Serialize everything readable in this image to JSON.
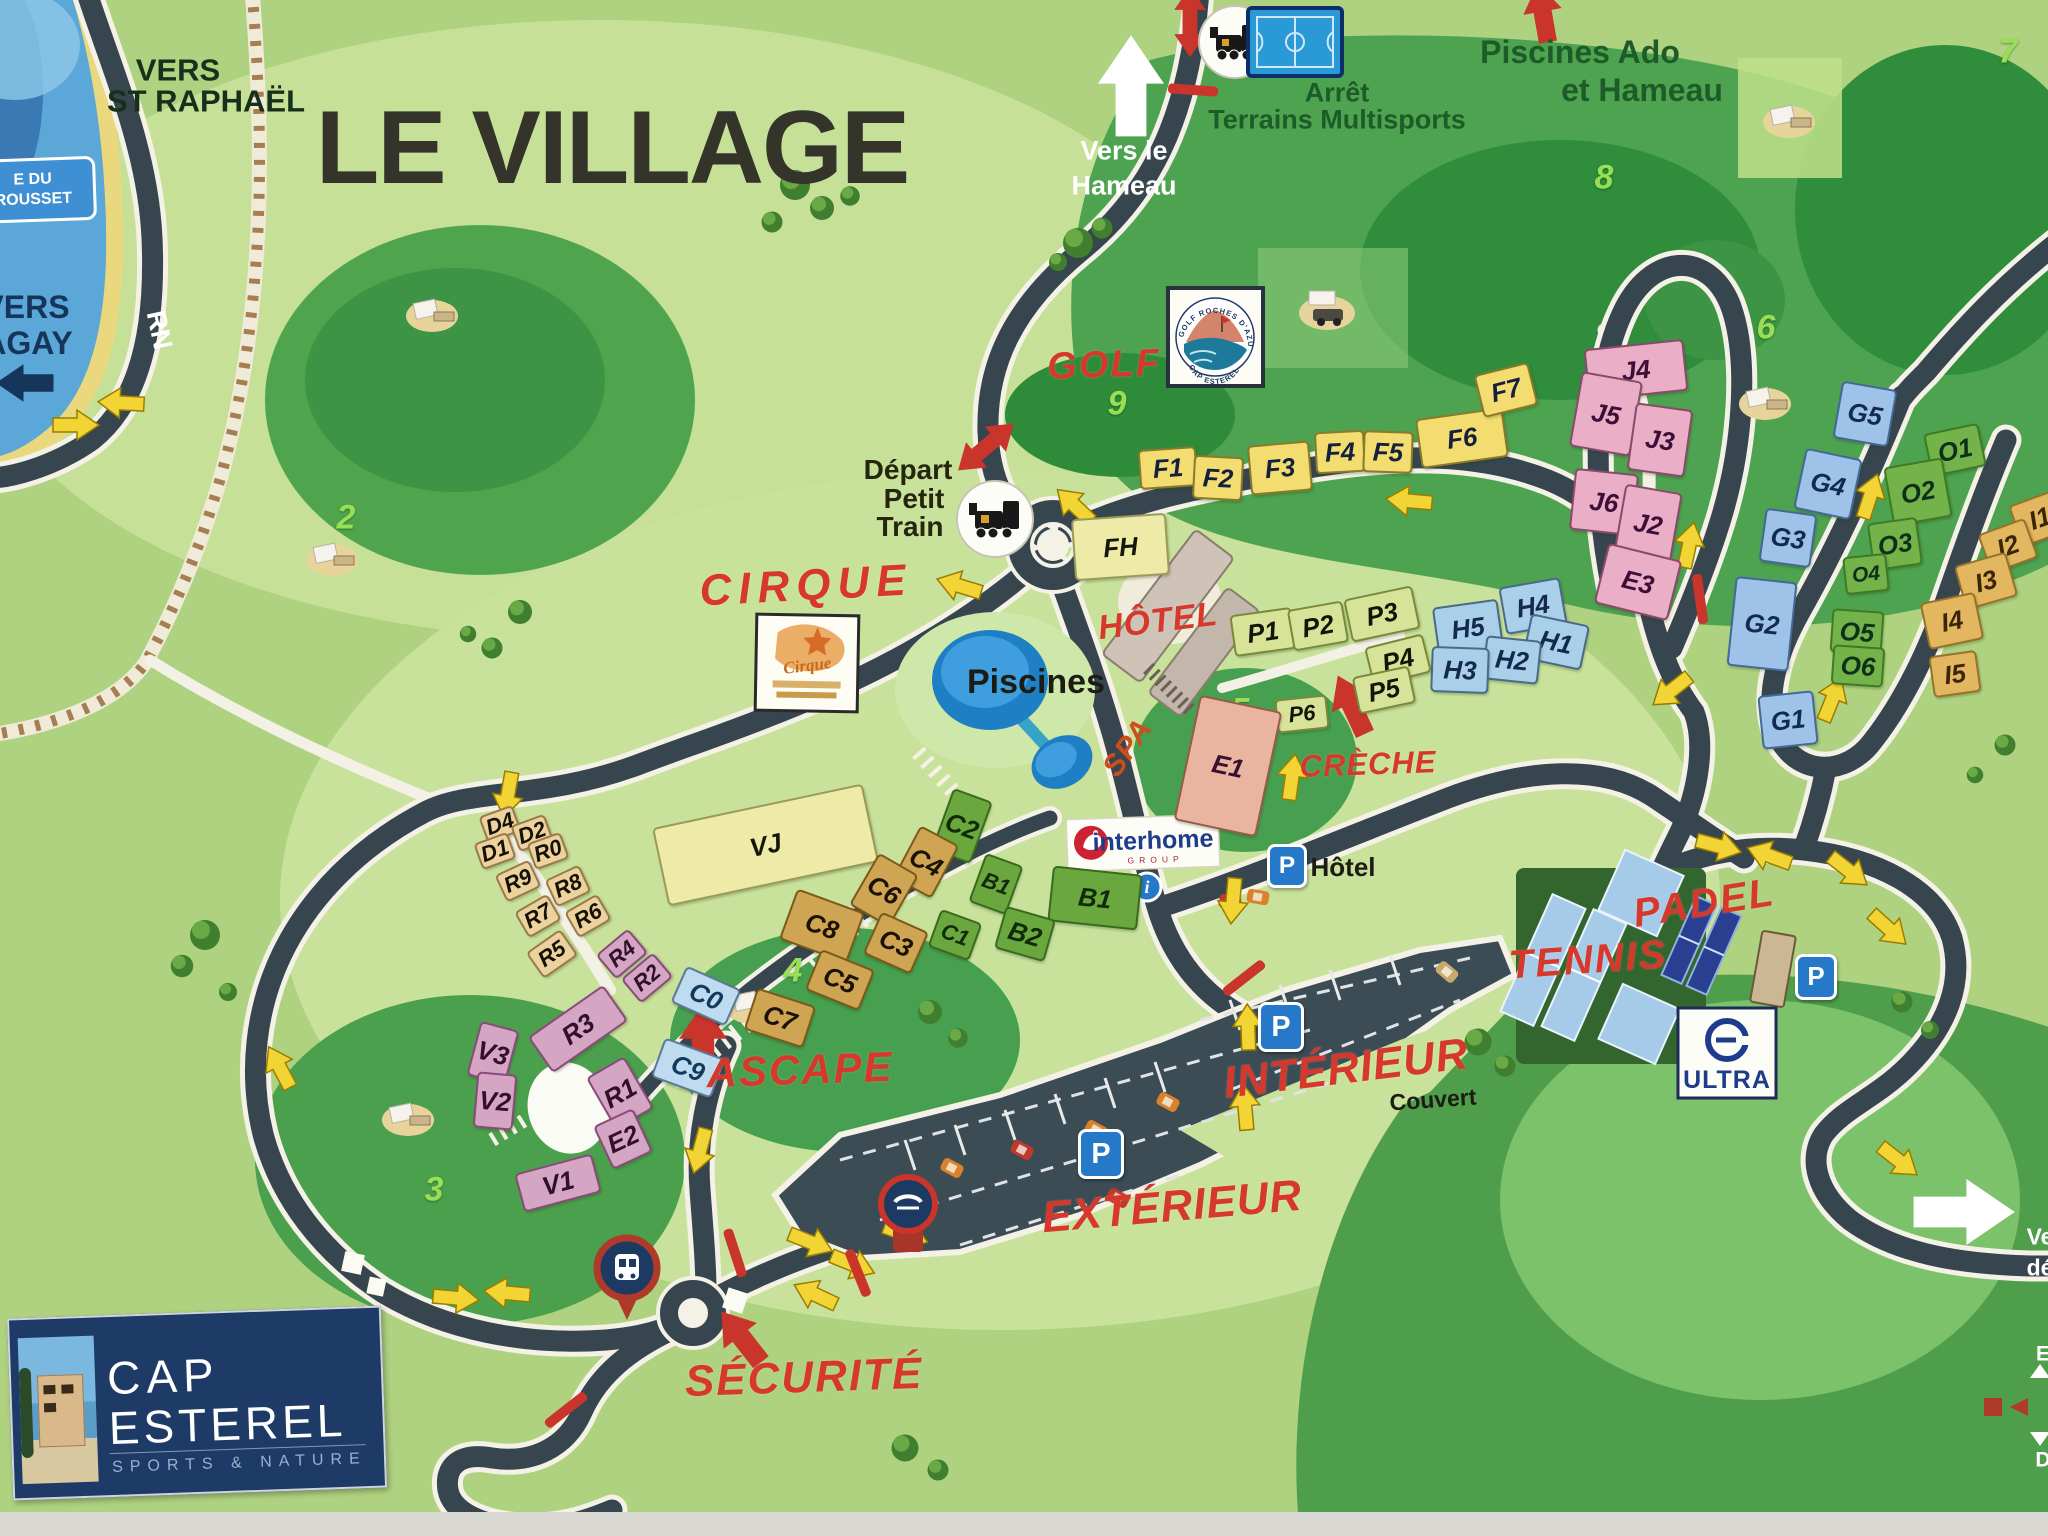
{
  "title": "LE VILLAGE",
  "colors": {
    "map_green": "#afd280",
    "dark_green": "#3c9444",
    "road": "#37464e",
    "accent_red": "#d6392b",
    "arrow_yellow": "#f2d435",
    "water_blue": "#5aa7d8",
    "navy_logo": "#1e3a66",
    "parking_blue": "#2678c8"
  },
  "signs": {
    "vers_st_raphael_1": "VERS",
    "vers_st_raphael_2": "ST RAPHAËL",
    "vers_agay_1": "VERS",
    "vers_agay_2": "AGAY",
    "beach_sign_1": "E DU",
    "beach_sign_2": "ROUSSET",
    "rn": "RN",
    "vers_hameau_1": "Vers le",
    "vers_hameau_2": "Hameau",
    "arret_1": "Arrêt",
    "arret_2": "Terrains Multisports",
    "piscines_ado_1": "Piscines Ado",
    "piscines_ado_2": "et Hameau",
    "depart_1": "Départ",
    "depart_2": "Petit",
    "depart_3": "Train",
    "edge_ve": "Ve",
    "edge_de": "dé",
    "edge_e": "E",
    "edge_d": "D"
  },
  "poi": [
    {
      "id": "golf",
      "text": "GOLF",
      "x": 1104,
      "y": 365,
      "s": 38,
      "rot": -2,
      "c": "red",
      "ls": 2
    },
    {
      "id": "cirque",
      "text": "CIRQUE",
      "x": 806,
      "y": 586,
      "s": 44,
      "rot": -3,
      "c": "red",
      "ls": 7
    },
    {
      "id": "hotel",
      "text": "HÔTEL",
      "x": 1158,
      "y": 621,
      "s": 34,
      "rot": -7,
      "c": "red",
      "ls": 1
    },
    {
      "id": "spa",
      "text": "SPA",
      "x": 1128,
      "y": 748,
      "s": 30,
      "rot": -55,
      "c": "orange",
      "ls": 1
    },
    {
      "id": "creche",
      "text": "CRÈCHE",
      "x": 1368,
      "y": 764,
      "s": 31,
      "rot": -2,
      "c": "red",
      "ls": 1
    },
    {
      "id": "ascape",
      "text": "ASCAPE",
      "x": 800,
      "y": 1070,
      "s": 42,
      "rot": -2,
      "c": "red",
      "ls": 2
    },
    {
      "id": "padel",
      "text": "PADEL",
      "x": 1704,
      "y": 903,
      "s": 40,
      "rot": -9,
      "c": "red",
      "ls": 2
    },
    {
      "id": "tennis",
      "text": "TENNIS",
      "x": 1588,
      "y": 960,
      "s": 40,
      "rot": -4,
      "c": "red",
      "ls": 2
    },
    {
      "id": "interieur",
      "text": "INTÉRIEUR",
      "x": 1346,
      "y": 1069,
      "s": 44,
      "rot": -7,
      "c": "red",
      "ls": 1
    },
    {
      "id": "couvert",
      "text": "Couvert",
      "x": 1433,
      "y": 1100,
      "s": 23,
      "rot": -4,
      "c": "black",
      "ls": 0
    },
    {
      "id": "exterieur",
      "text": "EXTÉRIEUR",
      "x": 1172,
      "y": 1207,
      "s": 44,
      "rot": -5,
      "c": "red",
      "ls": 1
    },
    {
      "id": "securite",
      "text": "SÉCURITÉ",
      "x": 804,
      "y": 1378,
      "s": 44,
      "rot": -2,
      "c": "red",
      "ls": 2
    },
    {
      "id": "piscines",
      "text": "Piscines",
      "x": 1036,
      "y": 682,
      "s": 34,
      "rot": 0,
      "c": "black",
      "ls": 0
    },
    {
      "id": "parking-hotel",
      "text": "Hôtel",
      "x": 1343,
      "y": 867,
      "s": 26,
      "rot": 0,
      "c": "black",
      "ls": 0
    }
  ],
  "golf_holes": [
    {
      "n": "2",
      "x": 346,
      "y": 518
    },
    {
      "n": "3",
      "x": 434,
      "y": 1190
    },
    {
      "n": "4",
      "x": 793,
      "y": 971
    },
    {
      "n": "5",
      "x": 1240,
      "y": 711
    },
    {
      "n": "6",
      "x": 1766,
      "y": 328
    },
    {
      "n": "7",
      "x": 2008,
      "y": 52
    },
    {
      "n": "8",
      "x": 1604,
      "y": 178
    },
    {
      "n": "9",
      "x": 1117,
      "y": 404
    }
  ],
  "buildings": [
    {
      "label": "F1",
      "x": 1168,
      "y": 468,
      "w": 58,
      "h": 40,
      "r": -4,
      "c": "yellow"
    },
    {
      "label": "F2",
      "x": 1218,
      "y": 478,
      "w": 50,
      "h": 44,
      "r": 3,
      "c": "yellow"
    },
    {
      "label": "F3",
      "x": 1280,
      "y": 468,
      "w": 62,
      "h": 50,
      "r": -5,
      "c": "yellow"
    },
    {
      "label": "F4",
      "x": 1340,
      "y": 452,
      "w": 50,
      "h": 42,
      "r": -3,
      "c": "yellow"
    },
    {
      "label": "F5",
      "x": 1388,
      "y": 452,
      "w": 50,
      "h": 42,
      "r": 2,
      "c": "yellow"
    },
    {
      "label": "F6",
      "x": 1462,
      "y": 438,
      "w": 88,
      "h": 50,
      "r": -8,
      "c": "yellow"
    },
    {
      "label": "F7",
      "x": 1506,
      "y": 390,
      "w": 56,
      "h": 44,
      "r": -14,
      "c": "yellow"
    },
    {
      "label": "FH",
      "x": 1120,
      "y": 547,
      "w": 95,
      "h": 62,
      "r": -4,
      "c": "paleyellow"
    },
    {
      "label": "VJ",
      "x": 765,
      "y": 845,
      "w": 215,
      "h": 80,
      "r": -12,
      "c": "paleyellow"
    },
    {
      "label": "J4",
      "x": 1636,
      "y": 370,
      "w": 100,
      "h": 52,
      "r": -6,
      "c": "pink"
    },
    {
      "label": "J5",
      "x": 1606,
      "y": 414,
      "w": 62,
      "h": 76,
      "r": 10,
      "c": "pink"
    },
    {
      "label": "J3",
      "x": 1660,
      "y": 440,
      "w": 58,
      "h": 68,
      "r": 8,
      "c": "pink"
    },
    {
      "label": "J6",
      "x": 1604,
      "y": 502,
      "w": 64,
      "h": 62,
      "r": 6,
      "c": "pink"
    },
    {
      "label": "J2",
      "x": 1648,
      "y": 524,
      "w": 58,
      "h": 72,
      "r": 10,
      "c": "pink"
    },
    {
      "label": "E3",
      "x": 1638,
      "y": 582,
      "w": 76,
      "h": 62,
      "r": 14,
      "c": "pink"
    },
    {
      "label": "H4",
      "x": 1533,
      "y": 606,
      "w": 62,
      "h": 48,
      "r": -10,
      "c": "blue"
    },
    {
      "label": "H5",
      "x": 1468,
      "y": 628,
      "w": 66,
      "h": 50,
      "r": -8,
      "c": "blue"
    },
    {
      "label": "H1",
      "x": 1556,
      "y": 642,
      "w": 60,
      "h": 46,
      "r": 12,
      "c": "blue"
    },
    {
      "label": "H2",
      "x": 1512,
      "y": 660,
      "w": 56,
      "h": 44,
      "r": 6,
      "c": "blue"
    },
    {
      "label": "H3",
      "x": 1460,
      "y": 670,
      "w": 58,
      "h": 46,
      "r": 2,
      "c": "blue"
    },
    {
      "label": "P1",
      "x": 1263,
      "y": 632,
      "w": 62,
      "h": 42,
      "r": -8,
      "c": "pgreen"
    },
    {
      "label": "P2",
      "x": 1318,
      "y": 626,
      "w": 56,
      "h": 42,
      "r": -10,
      "c": "pgreen"
    },
    {
      "label": "P3",
      "x": 1382,
      "y": 614,
      "w": 70,
      "h": 44,
      "r": -12,
      "c": "pgreen"
    },
    {
      "label": "P4",
      "x": 1398,
      "y": 660,
      "w": 60,
      "h": 40,
      "r": -14,
      "c": "pgreen"
    },
    {
      "label": "P5",
      "x": 1384,
      "y": 690,
      "w": 58,
      "h": 38,
      "r": -12,
      "c": "pgreen"
    },
    {
      "label": "P6",
      "x": 1302,
      "y": 714,
      "w": 52,
      "h": 34,
      "r": -6,
      "c": "pgreen",
      "fs": 22
    },
    {
      "label": "E1",
      "x": 1228,
      "y": 766,
      "w": 84,
      "h": 128,
      "r": 12,
      "c": "salmon"
    },
    {
      "label": "C2",
      "x": 962,
      "y": 826,
      "w": 42,
      "h": 66,
      "r": 20,
      "c": "green"
    },
    {
      "label": "C4",
      "x": 926,
      "y": 862,
      "w": 44,
      "h": 60,
      "r": 28,
      "c": "gold"
    },
    {
      "label": "C6",
      "x": 884,
      "y": 890,
      "w": 46,
      "h": 60,
      "r": 30,
      "c": "gold"
    },
    {
      "label": "C8",
      "x": 822,
      "y": 926,
      "w": 72,
      "h": 54,
      "r": 20,
      "c": "gold"
    },
    {
      "label": "C3",
      "x": 896,
      "y": 943,
      "w": 52,
      "h": 46,
      "r": 24,
      "c": "gold"
    },
    {
      "label": "C5",
      "x": 840,
      "y": 980,
      "w": 58,
      "h": 44,
      "r": 22,
      "c": "gold"
    },
    {
      "label": "C7",
      "x": 780,
      "y": 1018,
      "w": 62,
      "h": 44,
      "r": 18,
      "c": "gold"
    },
    {
      "label": "C0",
      "x": 706,
      "y": 996,
      "w": 60,
      "h": 40,
      "r": 24,
      "c": "bluelight"
    },
    {
      "label": "C9",
      "x": 688,
      "y": 1068,
      "w": 64,
      "h": 42,
      "r": 20,
      "c": "bluelight"
    },
    {
      "label": "B1",
      "x": 996,
      "y": 884,
      "w": 40,
      "h": 52,
      "r": 20,
      "c": "green",
      "fs": 22
    },
    {
      "label": "B1",
      "x": 1095,
      "y": 898,
      "w": 90,
      "h": 56,
      "r": 6,
      "c": "green"
    },
    {
      "label": "B2",
      "x": 1025,
      "y": 934,
      "w": 52,
      "h": 44,
      "r": 16,
      "c": "green"
    },
    {
      "label": "C1",
      "x": 955,
      "y": 935,
      "w": 44,
      "h": 40,
      "r": 20,
      "c": "green",
      "fs": 22
    },
    {
      "label": "D4",
      "x": 500,
      "y": 824,
      "w": 36,
      "h": 28,
      "r": -20,
      "c": "tan",
      "fs": 22
    },
    {
      "label": "D2",
      "x": 532,
      "y": 833,
      "w": 36,
      "h": 28,
      "r": -20,
      "c": "tan",
      "fs": 22
    },
    {
      "label": "D1",
      "x": 495,
      "y": 851,
      "w": 36,
      "h": 28,
      "r": -20,
      "c": "tan",
      "fs": 22
    },
    {
      "label": "R0",
      "x": 548,
      "y": 851,
      "w": 36,
      "h": 28,
      "r": -20,
      "c": "tan",
      "fs": 22
    },
    {
      "label": "R9",
      "x": 518,
      "y": 881,
      "w": 38,
      "h": 30,
      "r": -25,
      "c": "tan",
      "fs": 22
    },
    {
      "label": "R8",
      "x": 568,
      "y": 886,
      "w": 38,
      "h": 30,
      "r": -25,
      "c": "tan",
      "fs": 22
    },
    {
      "label": "R7",
      "x": 538,
      "y": 916,
      "w": 38,
      "h": 30,
      "r": -30,
      "c": "tan",
      "fs": 22
    },
    {
      "label": "R6",
      "x": 588,
      "y": 916,
      "w": 38,
      "h": 30,
      "r": -30,
      "c": "tan",
      "fs": 22
    },
    {
      "label": "R5",
      "x": 552,
      "y": 954,
      "w": 42,
      "h": 32,
      "r": -35,
      "c": "tan",
      "fs": 22
    },
    {
      "label": "R4",
      "x": 622,
      "y": 954,
      "w": 42,
      "h": 32,
      "r": -40,
      "c": "mauve",
      "fs": 22
    },
    {
      "label": "R2",
      "x": 647,
      "y": 978,
      "w": 42,
      "h": 32,
      "r": -40,
      "c": "mauve",
      "fs": 22
    },
    {
      "label": "R3",
      "x": 578,
      "y": 1029,
      "w": 92,
      "h": 44,
      "r": -35,
      "c": "mauve"
    },
    {
      "label": "V3",
      "x": 493,
      "y": 1053,
      "w": 40,
      "h": 56,
      "r": 15,
      "c": "mauve"
    },
    {
      "label": "V2",
      "x": 495,
      "y": 1101,
      "w": 40,
      "h": 56,
      "r": 5,
      "c": "mauve"
    },
    {
      "label": "V1",
      "x": 558,
      "y": 1183,
      "w": 80,
      "h": 40,
      "r": -15,
      "c": "mauve"
    },
    {
      "label": "R1",
      "x": 620,
      "y": 1093,
      "w": 44,
      "h": 60,
      "r": -30,
      "c": "mauve"
    },
    {
      "label": "E2",
      "x": 623,
      "y": 1139,
      "w": 44,
      "h": 48,
      "r": -25,
      "c": "mauve"
    },
    {
      "label": "G5",
      "x": 1865,
      "y": 414,
      "w": 56,
      "h": 58,
      "r": 10,
      "c": "gblue"
    },
    {
      "label": "G4",
      "x": 1828,
      "y": 484,
      "w": 58,
      "h": 62,
      "r": 12,
      "c": "gblue"
    },
    {
      "label": "G3",
      "x": 1788,
      "y": 538,
      "w": 52,
      "h": 54,
      "r": 8,
      "c": "gblue"
    },
    {
      "label": "G2",
      "x": 1762,
      "y": 624,
      "w": 62,
      "h": 90,
      "r": 6,
      "c": "gblue"
    },
    {
      "label": "G1",
      "x": 1788,
      "y": 720,
      "w": 56,
      "h": 54,
      "r": -6,
      "c": "gblue"
    },
    {
      "label": "O1",
      "x": 1955,
      "y": 450,
      "w": 56,
      "h": 44,
      "r": -12,
      "c": "ogreen"
    },
    {
      "label": "O2",
      "x": 1918,
      "y": 492,
      "w": 60,
      "h": 60,
      "r": -10,
      "c": "ogreen"
    },
    {
      "label": "O3",
      "x": 1895,
      "y": 544,
      "w": 50,
      "h": 48,
      "r": -8,
      "c": "ogreen"
    },
    {
      "label": "O4",
      "x": 1866,
      "y": 574,
      "w": 44,
      "h": 38,
      "r": -6,
      "c": "ogreen",
      "fs": 21
    },
    {
      "label": "O5",
      "x": 1857,
      "y": 632,
      "w": 52,
      "h": 44,
      "r": 4,
      "c": "ogreen"
    },
    {
      "label": "O6",
      "x": 1858,
      "y": 666,
      "w": 52,
      "h": 40,
      "r": 4,
      "c": "ogreen"
    },
    {
      "label": "I1",
      "x": 2040,
      "y": 518,
      "w": 52,
      "h": 44,
      "r": -20,
      "c": "itan"
    },
    {
      "label": "I2",
      "x": 2008,
      "y": 546,
      "w": 50,
      "h": 42,
      "r": -20,
      "c": "itan"
    },
    {
      "label": "I3",
      "x": 1986,
      "y": 581,
      "w": 54,
      "h": 46,
      "r": -16,
      "c": "itan"
    },
    {
      "label": "I4",
      "x": 1952,
      "y": 621,
      "w": 56,
      "h": 48,
      "r": -12,
      "c": "itan"
    },
    {
      "label": "I5",
      "x": 1955,
      "y": 674,
      "w": 48,
      "h": 42,
      "r": -8,
      "c": "itan"
    }
  ],
  "psigns": [
    {
      "x": 1287,
      "y": 866,
      "s": 34
    },
    {
      "x": 1281,
      "y": 1027,
      "s": 40
    },
    {
      "x": 1101,
      "y": 1154,
      "s": 40
    },
    {
      "x": 1816,
      "y": 977,
      "s": 36
    }
  ],
  "logos": {
    "parking": "P",
    "info": "i",
    "cap_line1": "CAP",
    "cap_line2": "ESTEREL",
    "cap_tagline": "SPORTS & NATURE",
    "ultra": "ULTRA",
    "interhome": "interhome",
    "interhome_sub": "GROUP",
    "golf_badge_top": "GOLF ROCHES D'AZUR",
    "golf_badge_bottom": "CAP ESTEREL",
    "cirque_poster": "Cirque"
  }
}
